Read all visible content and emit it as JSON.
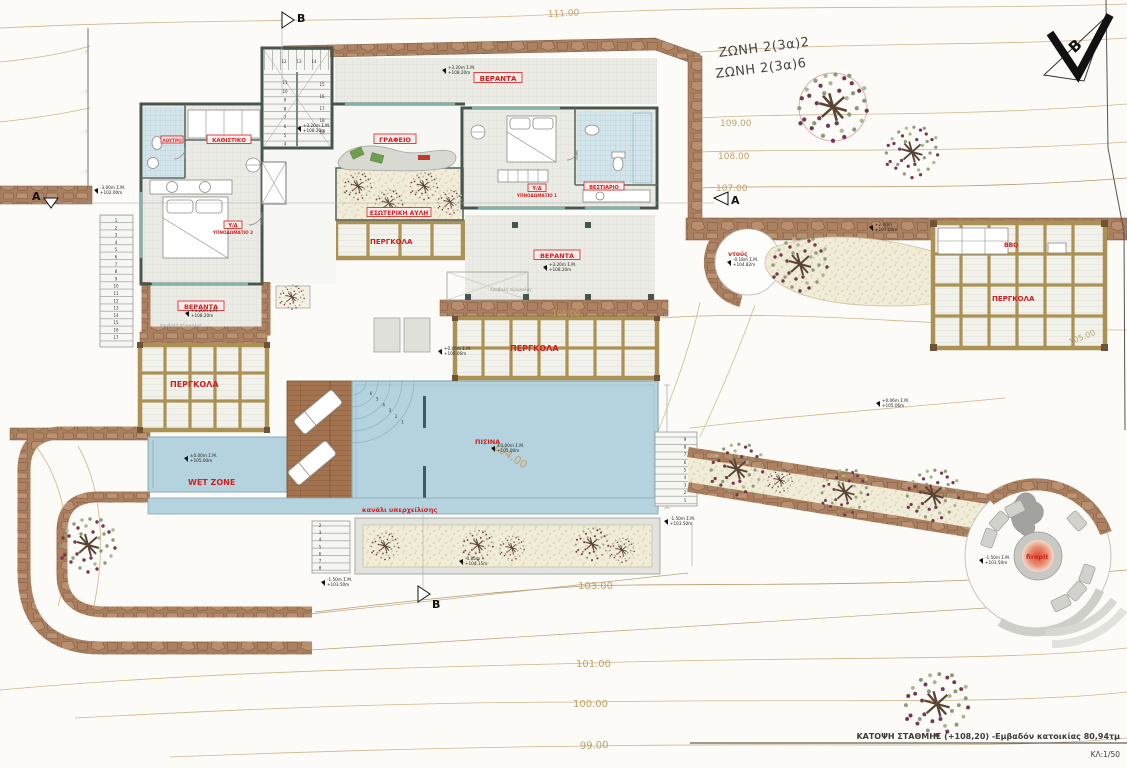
{
  "zones": {
    "z1": "ΖΩΝΗ 2(3α)2",
    "z2": "ΖΩΝΗ 2(3α)6"
  },
  "north": {
    "letter": "B"
  },
  "sections": {
    "a": "A",
    "b": "B"
  },
  "contours": {
    "c111": "111.00",
    "c109": "109.00",
    "c108": "108.00",
    "c107": "107.00",
    "c105a": "105.00",
    "c105b": "105.00",
    "c104": "104.00",
    "c103": "103.00",
    "c101": "101.00",
    "c100": "100.00",
    "c99": "99.00"
  },
  "rooms": {
    "office": "ΓΡΑΦΕΙΟ",
    "sitting": "ΚΑΘΙΣΤΙΚΟ",
    "closet": "ΒΕΣΤΙΑΡΙΟ",
    "bath": "ΛΟΥΤΡΟ",
    "bedroom1_line1": "Υ/Δ",
    "bedroom1_line2": "ΥΠΝΟΔΩΜΑΤΙΟ 1",
    "bedroom2_line1": "Υ/Δ",
    "bedroom2_line2": "ΥΠΝΟΔΩΜΑΤΙΟ 2",
    "veranda": "ΒΕΡΑΝΤΑ",
    "courtyard": "ΕΣΩΤΕΡΙΚΗ ΑΥΛΗ"
  },
  "outdoor": {
    "pergola": "ΠΕΡΓΚΟΛΑ",
    "pool": "ΠΙΣΙΝΑ",
    "wet_zone": "WET ZONE",
    "overflow_channel": "κανάλι υπερχείλισης",
    "shower": "ντούς",
    "bbq": "BBQ",
    "firepit": "firepit",
    "pergola_projection": "προβολή πέργκολας"
  },
  "levels": [
    {
      "l1": "+3.20m Σ.Μ.",
      "l2": "+108.20m"
    },
    {
      "l1": "+3.20m Σ.Μ.",
      "l2": "+108.20m"
    },
    {
      "l1": "+3.20m Σ.Μ.",
      "l2": "+108.20m"
    },
    {
      "l1": "+3.20m Σ.Μ.",
      "l2": "+108.20m"
    },
    {
      "l1": "-3.00m Σ.Μ.",
      "l2": "+102.00m"
    },
    {
      "l1": "±0.00m Σ.Μ.",
      "l2": "+105.00m"
    },
    {
      "l1": "±0.00m Σ.Μ.",
      "l2": "+105.00m"
    },
    {
      "l1": "+0.06m Σ.Μ.",
      "l2": "+105.06m"
    },
    {
      "l1": "+0.06m Σ.Μ.",
      "l2": "+105.06m"
    },
    {
      "l1": "-0.18m Σ.Μ.",
      "l2": "+104.82m"
    },
    {
      "l1": "+2.00m",
      "l2": "+107.00m"
    },
    {
      "l1": "-0.85m",
      "l2": "+104.15m"
    },
    {
      "l1": "-1.50m Σ.Μ.",
      "l2": "+103.50m"
    },
    {
      "l1": "-1.50m Σ.Μ.",
      "l2": "+103.50m"
    },
    {
      "l1": "-1.50m Σ.Μ.",
      "l2": "+103.50m"
    }
  ],
  "steps": {
    "stair_left": [
      "11",
      "10",
      "9",
      "8",
      "7",
      "6",
      "5",
      "4"
    ],
    "stair_top": [
      "12",
      "13",
      "14"
    ],
    "stair_right": [
      "15",
      "16",
      "17",
      "18",
      "19"
    ],
    "west": [
      "1",
      "2",
      "3",
      "4",
      "5",
      "6",
      "7",
      "8",
      "9",
      "10",
      "11",
      "12",
      "13",
      "14",
      "15",
      "16",
      "17"
    ],
    "east": [
      "9",
      "8",
      "7",
      "6",
      "5",
      "4",
      "3",
      "2",
      "1"
    ],
    "bed": [
      "2",
      "3",
      "4",
      "5",
      "6",
      "7",
      "8"
    ],
    "pool": [
      "6",
      "5",
      "4",
      "3",
      "2",
      "1"
    ]
  },
  "titleblock": {
    "caption": "ΚΑΤΟΨΗ ΣΤΑΘΜΗΣ (+108,20) -Εμβαδόν κατοικίας 80,94τμ",
    "scale": "ΚΛ:1/50"
  },
  "colors": {
    "label_red": "#d01f1f",
    "water": "#b5d3de",
    "stone": "#a97f5f",
    "wood": "#a3734f",
    "contour": "#cfb68a",
    "tree_green": "#8b9a78",
    "tree_maroon": "#74384e",
    "firepit_glow": "#dd5034"
  }
}
